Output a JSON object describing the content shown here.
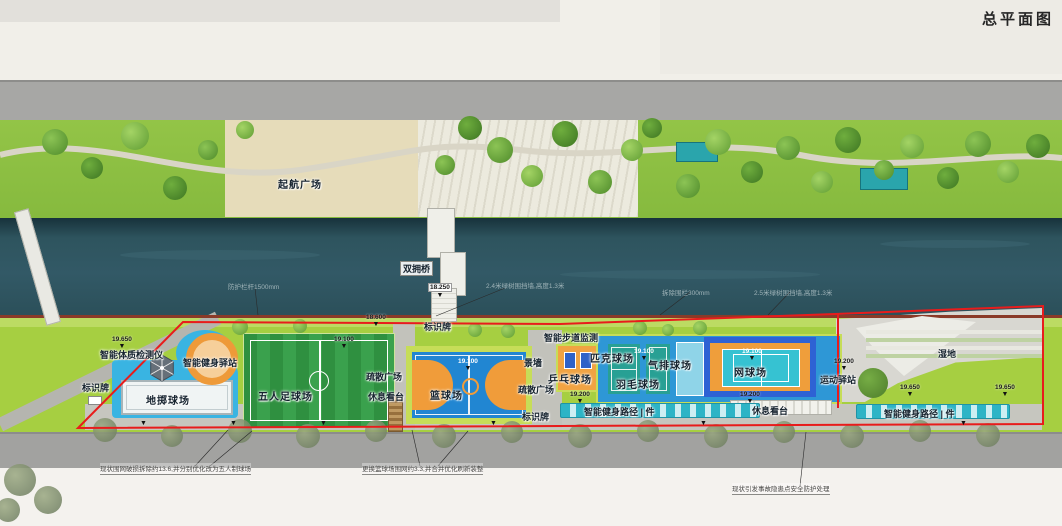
{
  "title": "总平面图",
  "colors": {
    "boundary_red": "#e81c1c",
    "river_teal": "#2e545e",
    "park_green": "#93c447",
    "court_blue": "#2186d2",
    "court_orange": "#f09c3a",
    "court_teal": "#28a094",
    "road_gray": "#a7a7a5",
    "fitness_cyan": "#2db4c6"
  },
  "labels": [
    {
      "id": "qihang-plaza",
      "text": "起航广场",
      "x": 278,
      "y": 176,
      "cls": "court"
    },
    {
      "id": "shuangyong-bridge",
      "text": "双拥桥",
      "x": 400,
      "y": 261,
      "cls": "boxed"
    },
    {
      "id": "sign-bridge",
      "text": "标识牌",
      "x": 424,
      "y": 320
    },
    {
      "id": "smart-walkway-monitor",
      "text": "智能步道监测",
      "x": 544,
      "y": 331
    },
    {
      "id": "fitness-tester",
      "text": "智能体质检测仪",
      "x": 100,
      "y": 348
    },
    {
      "id": "fitness-station",
      "text": "智能健身驿站",
      "x": 183,
      "y": 356
    },
    {
      "id": "sign-left",
      "text": "标识牌",
      "x": 82,
      "y": 381
    },
    {
      "id": "bocce-court",
      "text": "地掷球场",
      "x": 146,
      "y": 392,
      "cls": "court"
    },
    {
      "id": "football-court",
      "text": "五人足球场",
      "x": 258,
      "y": 388,
      "cls": "court"
    },
    {
      "id": "evac-plaza-left",
      "text": "疏散广场",
      "x": 366,
      "y": 370
    },
    {
      "id": "rest-stand-left",
      "text": "休息看台",
      "x": 368,
      "y": 390
    },
    {
      "id": "basketball-court",
      "text": "篮球场",
      "x": 430,
      "y": 387,
      "cls": "court"
    },
    {
      "id": "scenic-wall",
      "text": "景墙",
      "x": 524,
      "y": 356
    },
    {
      "id": "evac-plaza-right",
      "text": "疏散广场",
      "x": 518,
      "y": 383
    },
    {
      "id": "sign-mid",
      "text": "标识牌",
      "x": 522,
      "y": 410
    },
    {
      "id": "pingpong-court",
      "text": "乒乓球场",
      "x": 548,
      "y": 371,
      "cls": "court"
    },
    {
      "id": "pickleball-court",
      "text": "匹克球场",
      "x": 590,
      "y": 350,
      "cls": "court"
    },
    {
      "id": "badminton-court",
      "text": "羽毛球场",
      "x": 616,
      "y": 376,
      "cls": "court"
    },
    {
      "id": "air-volleyball-court",
      "text": "气排球场",
      "x": 648,
      "y": 357,
      "cls": "court"
    },
    {
      "id": "tennis-court",
      "text": "网球场",
      "x": 734,
      "y": 364,
      "cls": "court"
    },
    {
      "id": "fitness-path-mid",
      "text": "智能健身路径 | 件",
      "x": 584,
      "y": 405
    },
    {
      "id": "rest-stand-right",
      "text": "休息看台",
      "x": 752,
      "y": 404
    },
    {
      "id": "sports-station",
      "text": "运动驿站",
      "x": 820,
      "y": 373
    },
    {
      "id": "wetland",
      "text": "湿地",
      "x": 938,
      "y": 347
    },
    {
      "id": "fitness-path-right",
      "text": "智能健身路径 | 件",
      "x": 884,
      "y": 407
    }
  ],
  "elevations": [
    {
      "value": "19.650",
      "x": 112,
      "y": 336
    },
    {
      "value": "18.600",
      "x": 366,
      "y": 314
    },
    {
      "value": "18.250",
      "x": 428,
      "y": 283,
      "boxed": true
    },
    {
      "value": "19.100",
      "x": 334,
      "y": 336
    },
    {
      "value": "19.100",
      "x": 458,
      "y": 358,
      "white": true
    },
    {
      "value": "19.100",
      "x": 634,
      "y": 348,
      "white": true
    },
    {
      "value": "19.100",
      "x": 742,
      "y": 348,
      "white": true
    },
    {
      "value": "19.200",
      "x": 570,
      "y": 391
    },
    {
      "value": "19.200",
      "x": 740,
      "y": 391
    },
    {
      "value": "19.200",
      "x": 834,
      "y": 358
    },
    {
      "value": "19.650",
      "x": 900,
      "y": 384
    },
    {
      "value": "19.650",
      "x": 995,
      "y": 384
    },
    {
      "value": "",
      "x": 140,
      "y": 420
    },
    {
      "value": "",
      "x": 230,
      "y": 420
    },
    {
      "value": "",
      "x": 320,
      "y": 420
    },
    {
      "value": "",
      "x": 490,
      "y": 420
    },
    {
      "value": "",
      "x": 700,
      "y": 420
    },
    {
      "value": "",
      "x": 960,
      "y": 420
    }
  ],
  "annotations": [
    {
      "id": "rail-note",
      "text": "防护栏杆1500mm",
      "x": 228,
      "y": 281,
      "cls": "on-water"
    },
    {
      "id": "hedge-note-left",
      "text": "2.4米绿树围挡墙,高度1.3米",
      "x": 486,
      "y": 280,
      "cls": "on-water"
    },
    {
      "id": "pipe-note",
      "text": "拆除围栏300mm",
      "x": 662,
      "y": 287,
      "cls": "on-water"
    },
    {
      "id": "hedge-note-right",
      "text": "2.5米绿树围挡墙,高度1.3米",
      "x": 754,
      "y": 287,
      "cls": "on-water"
    },
    {
      "id": "note-football",
      "text": "现状围网破损拆除约13.6,并分别优化改为五人制球场",
      "x": 100,
      "y": 463,
      "cls": "underline"
    },
    {
      "id": "note-basketball",
      "text": "更换篮球场围网约3.3,并合并优化刷新装整",
      "x": 362,
      "y": 463,
      "cls": "underline"
    },
    {
      "id": "note-safety",
      "text": "现状引发事故隐患点安全防护处理",
      "x": 732,
      "y": 483,
      "cls": "underline"
    }
  ]
}
